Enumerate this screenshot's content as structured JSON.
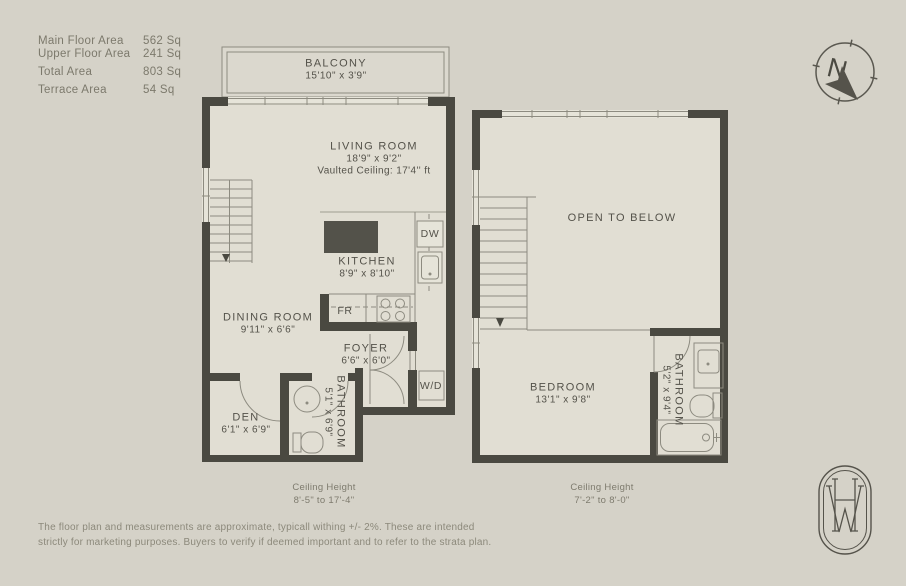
{
  "legend": {
    "rows": [
      {
        "label": "Main Floor Area",
        "value": "562 Sq"
      },
      {
        "label": "Upper Floor Area",
        "value": "241 Sq"
      },
      {
        "label": "Total Area",
        "value": "803 Sq"
      },
      {
        "label": "Terrace Area",
        "value": "54 Sq"
      }
    ]
  },
  "main_floor": {
    "balcony": {
      "name": "BALCONY",
      "dims": "15'10\" x 3'9\""
    },
    "living_room": {
      "name": "LIVING ROOM",
      "dims": "18'9\" x 9'2\"",
      "note": "Vaulted Ceiling: 17'4'' ft"
    },
    "kitchen": {
      "name": "KITCHEN",
      "dims": "8'9\" x 8'10\""
    },
    "dining_room": {
      "name": "DINING ROOM",
      "dims": "9'11\" x 6'6\""
    },
    "foyer": {
      "name": "FOYER",
      "dims": "6'6\" x 6'0\""
    },
    "den": {
      "name": "DEN",
      "dims": "6'1\" x 6'9\""
    },
    "bathroom": {
      "name": "BATHROOM",
      "dims": "5'1\" x 6'9\""
    },
    "appliances": {
      "dishwasher": "DW",
      "fridge": "FR",
      "washer_dryer": "W/D"
    },
    "ceiling": {
      "label": "Ceiling Height",
      "range": "8'-5\" to 17'-4\""
    }
  },
  "upper_floor": {
    "open_to_below": "OPEN TO BELOW",
    "bedroom": {
      "name": "BEDROOM",
      "dims": "13'1\" x 9'8\""
    },
    "bathroom": {
      "name": "BATHROOM",
      "dims": "5'2\" x 9'4\""
    },
    "ceiling": {
      "label": "Ceiling Height",
      "range": "7'-2\" to 8'-0\""
    }
  },
  "compass": {
    "letter": "N",
    "icon": "north-arrow"
  },
  "logo": {
    "icon": "hw-monogram"
  },
  "disclaimer": {
    "line1": "The floor plan and measurements are approximate, typicall withing +/- 2%. These are intended",
    "line2": "strictly for marketing purposes. Buyers to verify if deemed important and to refer to the strata plan."
  },
  "colors": {
    "background": "#d5d2c8",
    "interior": "#e1ded3",
    "walls": "#4a4941",
    "lines": "#8d8b80",
    "text": "#54524a"
  }
}
